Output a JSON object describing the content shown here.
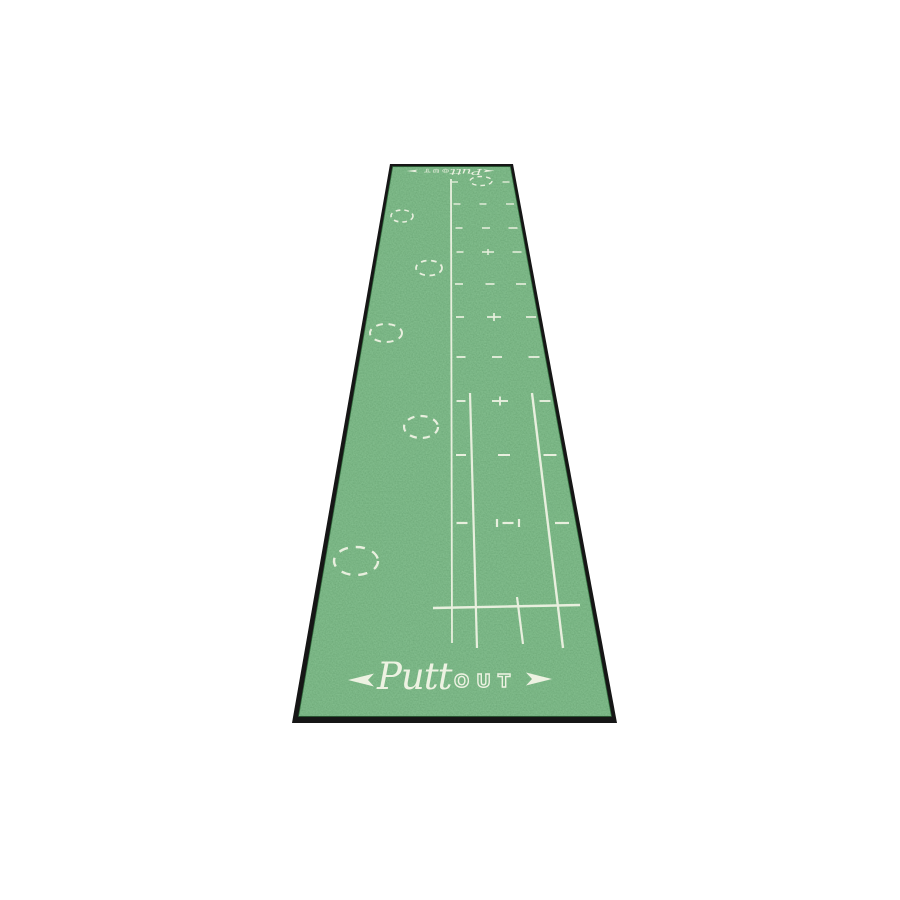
{
  "image_type": "product-photo",
  "product": {
    "name": "PuttOut Golf Putting Mat",
    "brand": "PuttOut",
    "description": "Long green putting practice mat shown in perspective on a plain white background, with white printed alignment line, putter guide lines, distance dashes, plus targets, dashed hole circles and PuttOut logos at both ends"
  },
  "brand": {
    "script": "Putt",
    "caps": "OUT"
  },
  "palette": {
    "background": "#ffffff",
    "mat_green": "#3e8148",
    "mat_green_light": "#4f9a58",
    "mat_green_dark": "#2f6b3a",
    "edge_black": "#161616",
    "marking_white": "#edf2e2"
  },
  "mat": {
    "outline_points": "390,164 513,164 617,723 292,723",
    "surface_points": "393,167 510,167 611,716 299,716"
  },
  "markings": {
    "lines": [
      {
        "name": "center-alignment-line",
        "x1": 451,
        "y1": 179,
        "x2": 452,
        "y2": 643,
        "w": 1.8
      },
      {
        "name": "putter-guide-line-left",
        "x1": 470,
        "y1": 393,
        "x2": 477,
        "y2": 648,
        "w": 2.2
      },
      {
        "name": "putter-guide-line-short",
        "x1": 517,
        "y1": 597,
        "x2": 523,
        "y2": 644,
        "w": 2.2
      },
      {
        "name": "putter-guide-line-right",
        "x1": 532,
        "y1": 393,
        "x2": 563,
        "y2": 648,
        "w": 2.4
      },
      {
        "name": "address-baseline",
        "x1": 433,
        "y1": 608,
        "x2": 580,
        "y2": 605,
        "w": 2.4
      }
    ],
    "target_circles": [
      {
        "cx": 481,
        "cy": 181,
        "rx": 11,
        "ry": 4.5,
        "t": 1.4
      },
      {
        "cx": 402,
        "cy": 216,
        "rx": 11,
        "ry": 6,
        "t": 1.6
      },
      {
        "cx": 429,
        "cy": 268,
        "rx": 13,
        "ry": 7.5,
        "t": 1.8
      },
      {
        "cx": 386,
        "cy": 333,
        "rx": 16,
        "ry": 9,
        "t": 2
      },
      {
        "cx": 421,
        "cy": 427,
        "rx": 17,
        "ry": 11,
        "t": 2.2
      },
      {
        "cx": 356,
        "cy": 561,
        "rx": 22,
        "ry": 14,
        "t": 2.4
      }
    ],
    "distance_rows": [
      {
        "y": 182,
        "t": 1.3,
        "marks": [
          {
            "type": "dash",
            "x": 455,
            "w": 6
          },
          {
            "type": "dash",
            "x": 506,
            "w": 7
          }
        ]
      },
      {
        "y": 204,
        "t": 1.4,
        "marks": [
          {
            "type": "dash",
            "x": 457,
            "w": 7
          },
          {
            "type": "dash",
            "x": 483,
            "w": 7
          },
          {
            "type": "dash",
            "x": 510,
            "w": 8
          }
        ]
      },
      {
        "y": 228,
        "t": 1.5,
        "marks": [
          {
            "type": "dash",
            "x": 459,
            "w": 7
          },
          {
            "type": "dash",
            "x": 486,
            "w": 8
          },
          {
            "type": "dash",
            "x": 513,
            "w": 9
          }
        ]
      },
      {
        "y": 252,
        "t": 1.5,
        "marks": [
          {
            "type": "dash",
            "x": 460,
            "w": 7
          },
          {
            "type": "plus",
            "x": 488,
            "w": 12,
            "h": 6
          },
          {
            "type": "dash",
            "x": 517,
            "w": 9
          }
        ]
      },
      {
        "y": 284,
        "t": 1.6,
        "marks": [
          {
            "type": "dash",
            "x": 459,
            "w": 8
          },
          {
            "type": "dash",
            "x": 490,
            "w": 9
          },
          {
            "type": "dash",
            "x": 521,
            "w": 10
          }
        ]
      },
      {
        "y": 317,
        "t": 1.7,
        "marks": [
          {
            "type": "dash",
            "x": 460,
            "w": 8
          },
          {
            "type": "plus",
            "x": 494,
            "w": 14,
            "h": 8
          },
          {
            "type": "dash",
            "x": 531,
            "w": 10
          }
        ]
      },
      {
        "y": 357,
        "t": 1.8,
        "marks": [
          {
            "type": "dash",
            "x": 461,
            "w": 9
          },
          {
            "type": "dash",
            "x": 497,
            "w": 10
          },
          {
            "type": "dash",
            "x": 534,
            "w": 11
          }
        ]
      },
      {
        "y": 401,
        "t": 1.9,
        "marks": [
          {
            "type": "dash",
            "x": 461,
            "w": 9
          },
          {
            "type": "plus",
            "x": 500,
            "w": 16,
            "h": 9
          },
          {
            "type": "dash",
            "x": 545,
            "w": 11
          }
        ]
      },
      {
        "y": 455,
        "t": 2.0,
        "marks": [
          {
            "type": "dash",
            "x": 461,
            "w": 10
          },
          {
            "type": "dash",
            "x": 504,
            "w": 12
          },
          {
            "type": "dash",
            "x": 550,
            "w": 13
          }
        ]
      },
      {
        "y": 523,
        "t": 2.2,
        "marks": [
          {
            "type": "dash",
            "x": 462,
            "w": 11
          },
          {
            "type": "gate",
            "x": 508,
            "w": 22,
            "h": 8
          },
          {
            "type": "dash",
            "x": 562,
            "w": 14
          }
        ]
      }
    ]
  },
  "logos": {
    "bottom": {
      "transform": "translate(449,679)"
    },
    "top": {
      "transform": "translate(451,171) rotate(180) scale(0.43,0.22)"
    }
  }
}
